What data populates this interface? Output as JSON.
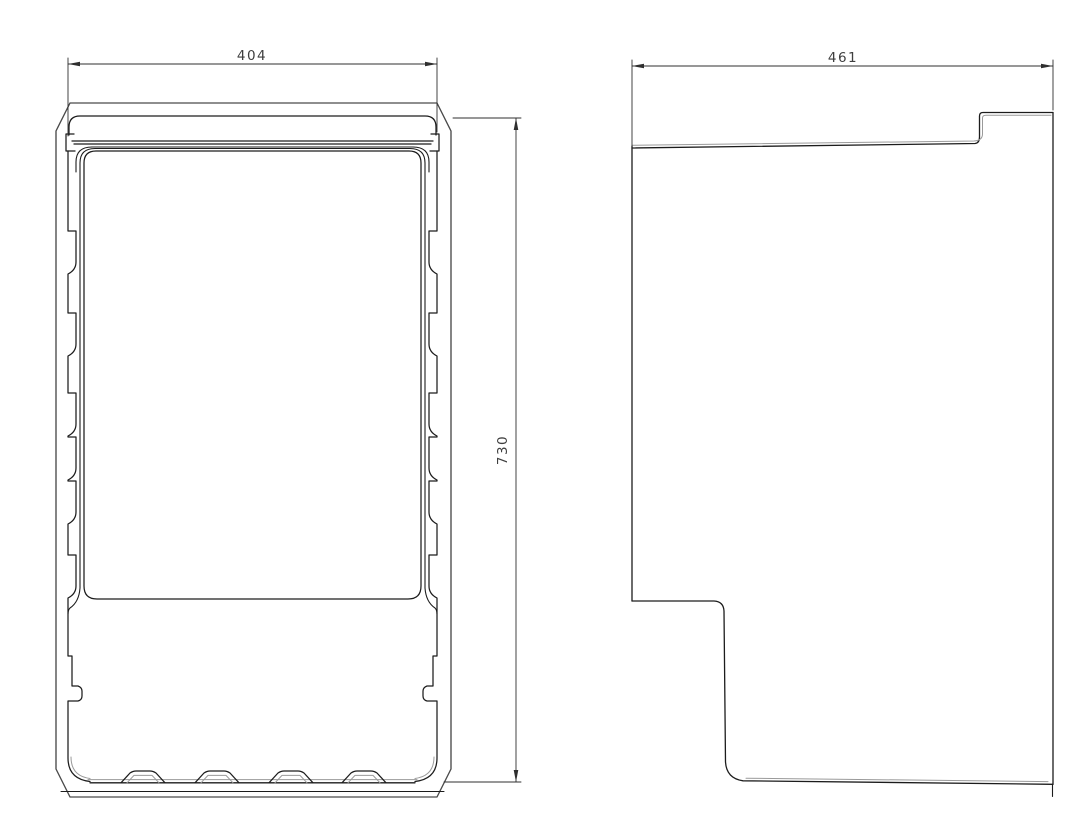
{
  "drawing": {
    "kind": "orthographic technical drawing, 2 views",
    "views": [
      {
        "name": "front-view",
        "dimensions": [
          {
            "label": "404",
            "axis": "width",
            "orientation": "horizontal"
          },
          {
            "label": "730",
            "axis": "height",
            "orientation": "vertical"
          }
        ]
      },
      {
        "name": "side-view",
        "dimensions": [
          {
            "label": "461",
            "axis": "depth",
            "orientation": "horizontal"
          }
        ]
      }
    ],
    "colors": {
      "background": "#ffffff",
      "main": "#1c1c1c",
      "frame": "#4a4a4a",
      "thin": "#9a9a9a",
      "dim": "#2f2f2f",
      "text": "#3f3f3f"
    }
  }
}
